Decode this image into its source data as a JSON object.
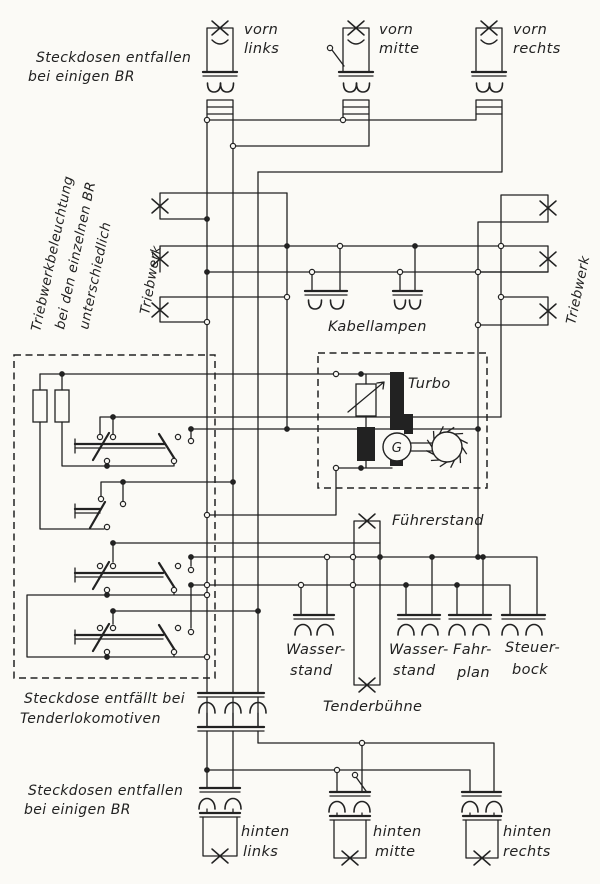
{
  "colors": {
    "ink": "#222222",
    "paper": "#fbfaf6"
  },
  "texts": {
    "note_top_1": "Steckdosen entfallen",
    "note_top_2": "bei einigen BR",
    "front_left_1": "vorn",
    "front_left_2": "links",
    "front_mid_1": "vorn",
    "front_mid_2": "mitte",
    "front_right_1": "vorn",
    "front_right_2": "rechts",
    "note_left_1": "Triebwerkbeleuchtung",
    "note_left_2": "bei den einzelnen BR",
    "note_left_3": "unterschiedlich",
    "triebwerk_left": "Triebwerk",
    "triebwerk_right": "Triebwerk",
    "kabellampen": "Kabellampen",
    "turbo": "Turbo",
    "generator": "G",
    "fuehrerstand": "Führerstand",
    "wasserstand1_1": "Wasser-",
    "wasserstand1_2": "stand",
    "wasserstand2_1": "Wasser-",
    "wasserstand2_2": "stand",
    "fahrplan_1": "Fahr-",
    "fahrplan_2": "plan",
    "steuerbock_1": "Steuer-",
    "steuerbock_2": "bock",
    "tenderbuehne": "Tenderbühne",
    "note_tender_1": "Steckdose entfällt bei",
    "note_tender_2": "Tenderlokomotiven",
    "note_bottom_1": "Steckdosen entfallen",
    "note_bottom_2": "bei einigen BR",
    "rear_left_1": "hinten",
    "rear_left_2": "links",
    "rear_mid_1": "hinten",
    "rear_mid_2": "mitte",
    "rear_right_1": "hinten",
    "rear_right_2": "rechts"
  }
}
